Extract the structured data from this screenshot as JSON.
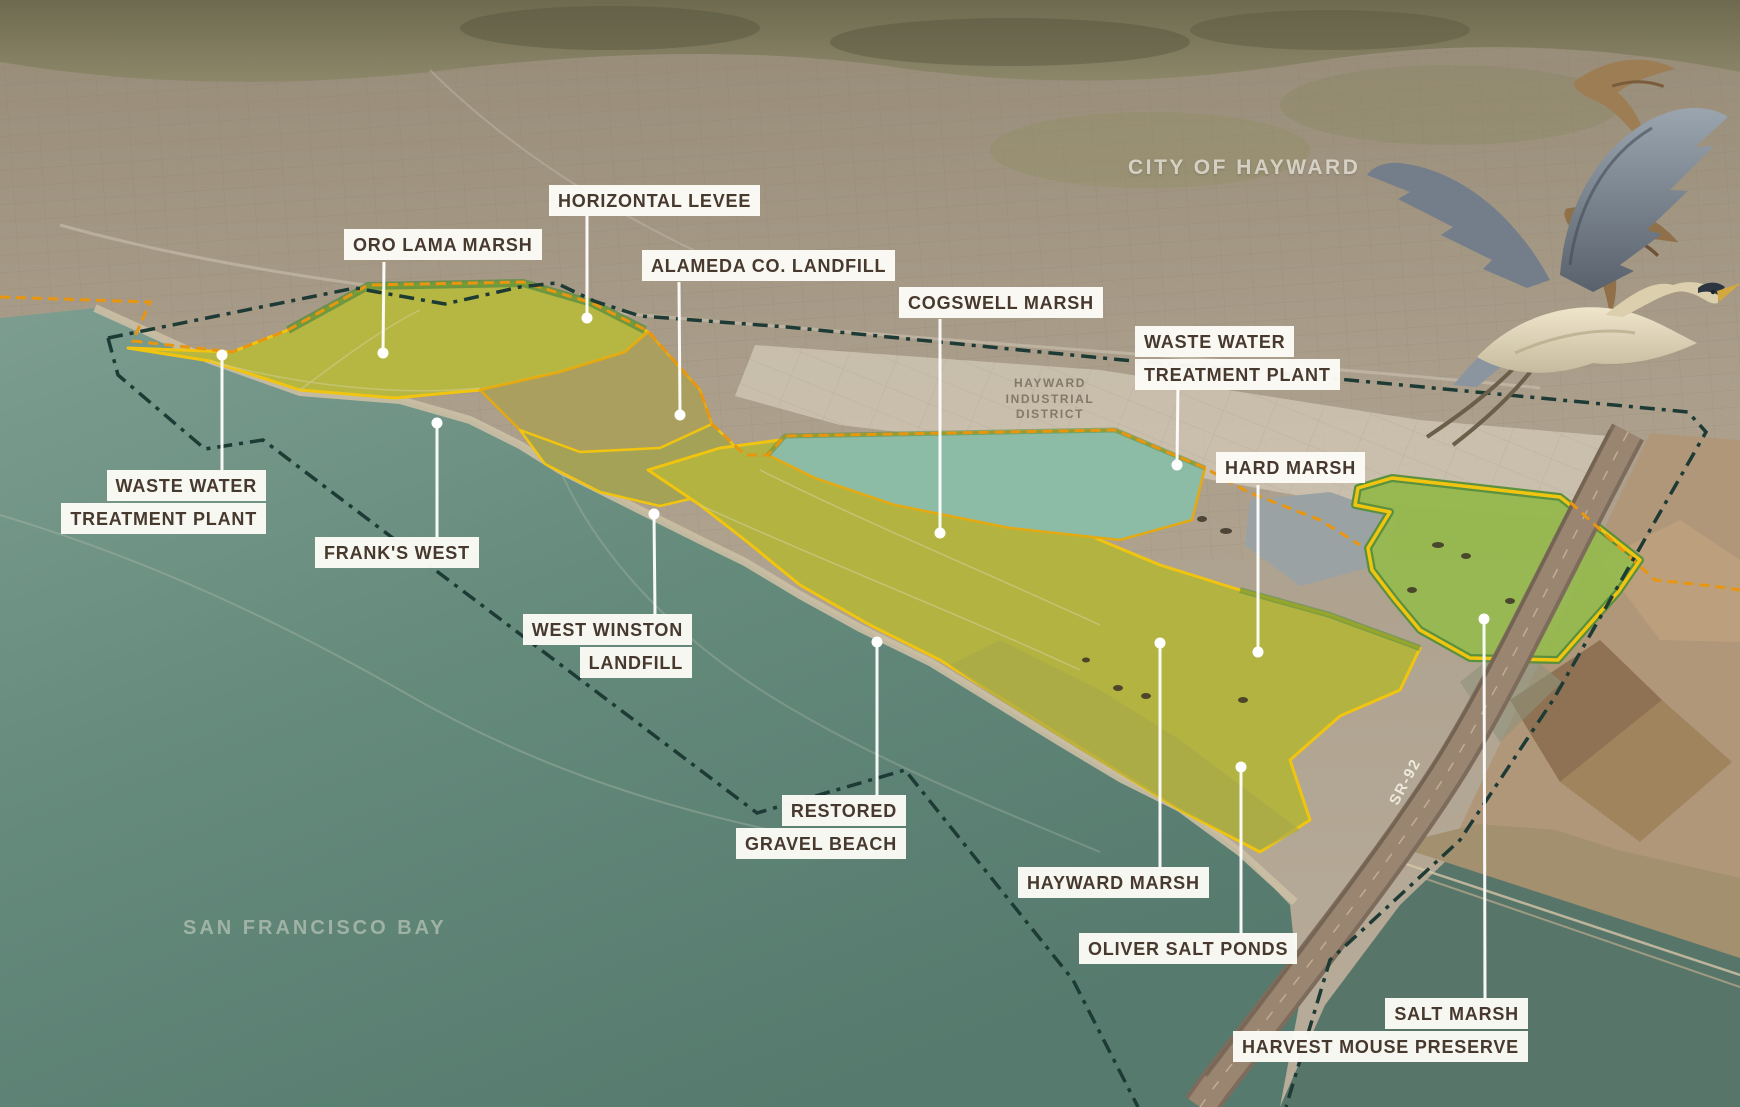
{
  "map": {
    "description": "Annotated oblique aerial rendering of the Hayward Regional Shoreline restoration plan on San Francisco Bay",
    "labels": [
      {
        "id": "horizontal-levee",
        "lines": [
          "HORIZONTAL LEVEE"
        ]
      },
      {
        "id": "oro-lama-marsh",
        "lines": [
          "ORO LAMA MARSH"
        ]
      },
      {
        "id": "alameda-co-landfill",
        "lines": [
          "ALAMEDA CO. LANDFILL"
        ]
      },
      {
        "id": "cogswell-marsh",
        "lines": [
          "COGSWELL MARSH"
        ]
      },
      {
        "id": "waste-water-treatment-plant-east",
        "lines": [
          "WASTE WATER",
          "TREATMENT PLANT"
        ]
      },
      {
        "id": "hard-marsh",
        "lines": [
          "HARD MARSH"
        ]
      },
      {
        "id": "waste-water-treatment-plant-west",
        "lines": [
          "WASTE WATER",
          "TREATMENT PLANT"
        ]
      },
      {
        "id": "franks-west",
        "lines": [
          "FRANK'S WEST"
        ]
      },
      {
        "id": "west-winston-landfill",
        "lines": [
          "WEST WINSTON",
          "LANDFILL"
        ]
      },
      {
        "id": "restored-gravel-beach",
        "lines": [
          "RESTORED",
          "GRAVEL BEACH"
        ]
      },
      {
        "id": "hayward-marsh",
        "lines": [
          "HAYWARD MARSH"
        ]
      },
      {
        "id": "oliver-salt-ponds",
        "lines": [
          "OLIVER SALT PONDS"
        ]
      },
      {
        "id": "salt-marsh-harvest-mouse-preserve",
        "lines": [
          "SALT MARSH",
          "HARVEST MOUSE PRESERVE"
        ]
      }
    ],
    "watermarks": {
      "city": "CITY OF HAYWARD",
      "district_lines": [
        "HAYWARD",
        "INDUSTRIAL",
        "DISTRICT"
      ],
      "bay": "SAN FRANCISCO BAY",
      "highway": "SR-92"
    },
    "colors": {
      "label_text": "#47392e",
      "label_chip_bg": "#fcfbf7",
      "leader_line": "#ffffff",
      "boundary_dash_navy": "#1d3a35",
      "boundary_dash_orange": "#e8960f",
      "marsh_outline_yellow": "#f1c50f",
      "levee_green": "#5d8f3e",
      "marsh_fill": "#b4b542",
      "preserve_green": "#97b950",
      "pond_teal": "#8cbca5",
      "bay_water": "#628779",
      "urban_tan": "#ac9f8d"
    }
  }
}
